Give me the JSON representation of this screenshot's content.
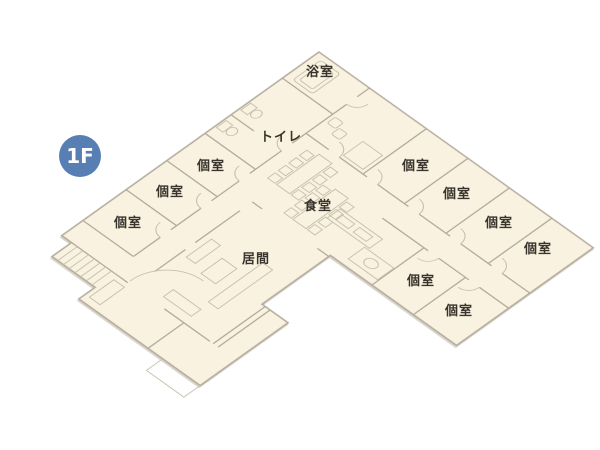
{
  "title": "1F floor plan",
  "floor_badge": {
    "label": "1F"
  },
  "palette": {
    "background": "#ffffff",
    "floor_fill": "#faf2e0",
    "outline_stroke": "#b3ab9b",
    "wall_stroke": "#b5ad9c",
    "detail_stroke": "#c9c1af",
    "label_color": "#38342d",
    "badge_fill": "#577fb4",
    "badge_text": "#ffffff"
  },
  "rooms": [
    {
      "id": "bathroom",
      "label": "浴室"
    },
    {
      "id": "toilet",
      "label": "トイレ"
    },
    {
      "id": "private-room-1",
      "label": "個室"
    },
    {
      "id": "private-room-2",
      "label": "個室"
    },
    {
      "id": "private-room-3",
      "label": "個室"
    },
    {
      "id": "private-room-4",
      "label": "個室"
    },
    {
      "id": "private-room-5",
      "label": "個室"
    },
    {
      "id": "private-room-6",
      "label": "個室"
    },
    {
      "id": "private-room-7",
      "label": "個室"
    },
    {
      "id": "private-room-8",
      "label": "個室"
    },
    {
      "id": "private-room-9",
      "label": "個室"
    },
    {
      "id": "dining",
      "label": "食堂"
    },
    {
      "id": "living",
      "label": "居間"
    }
  ]
}
